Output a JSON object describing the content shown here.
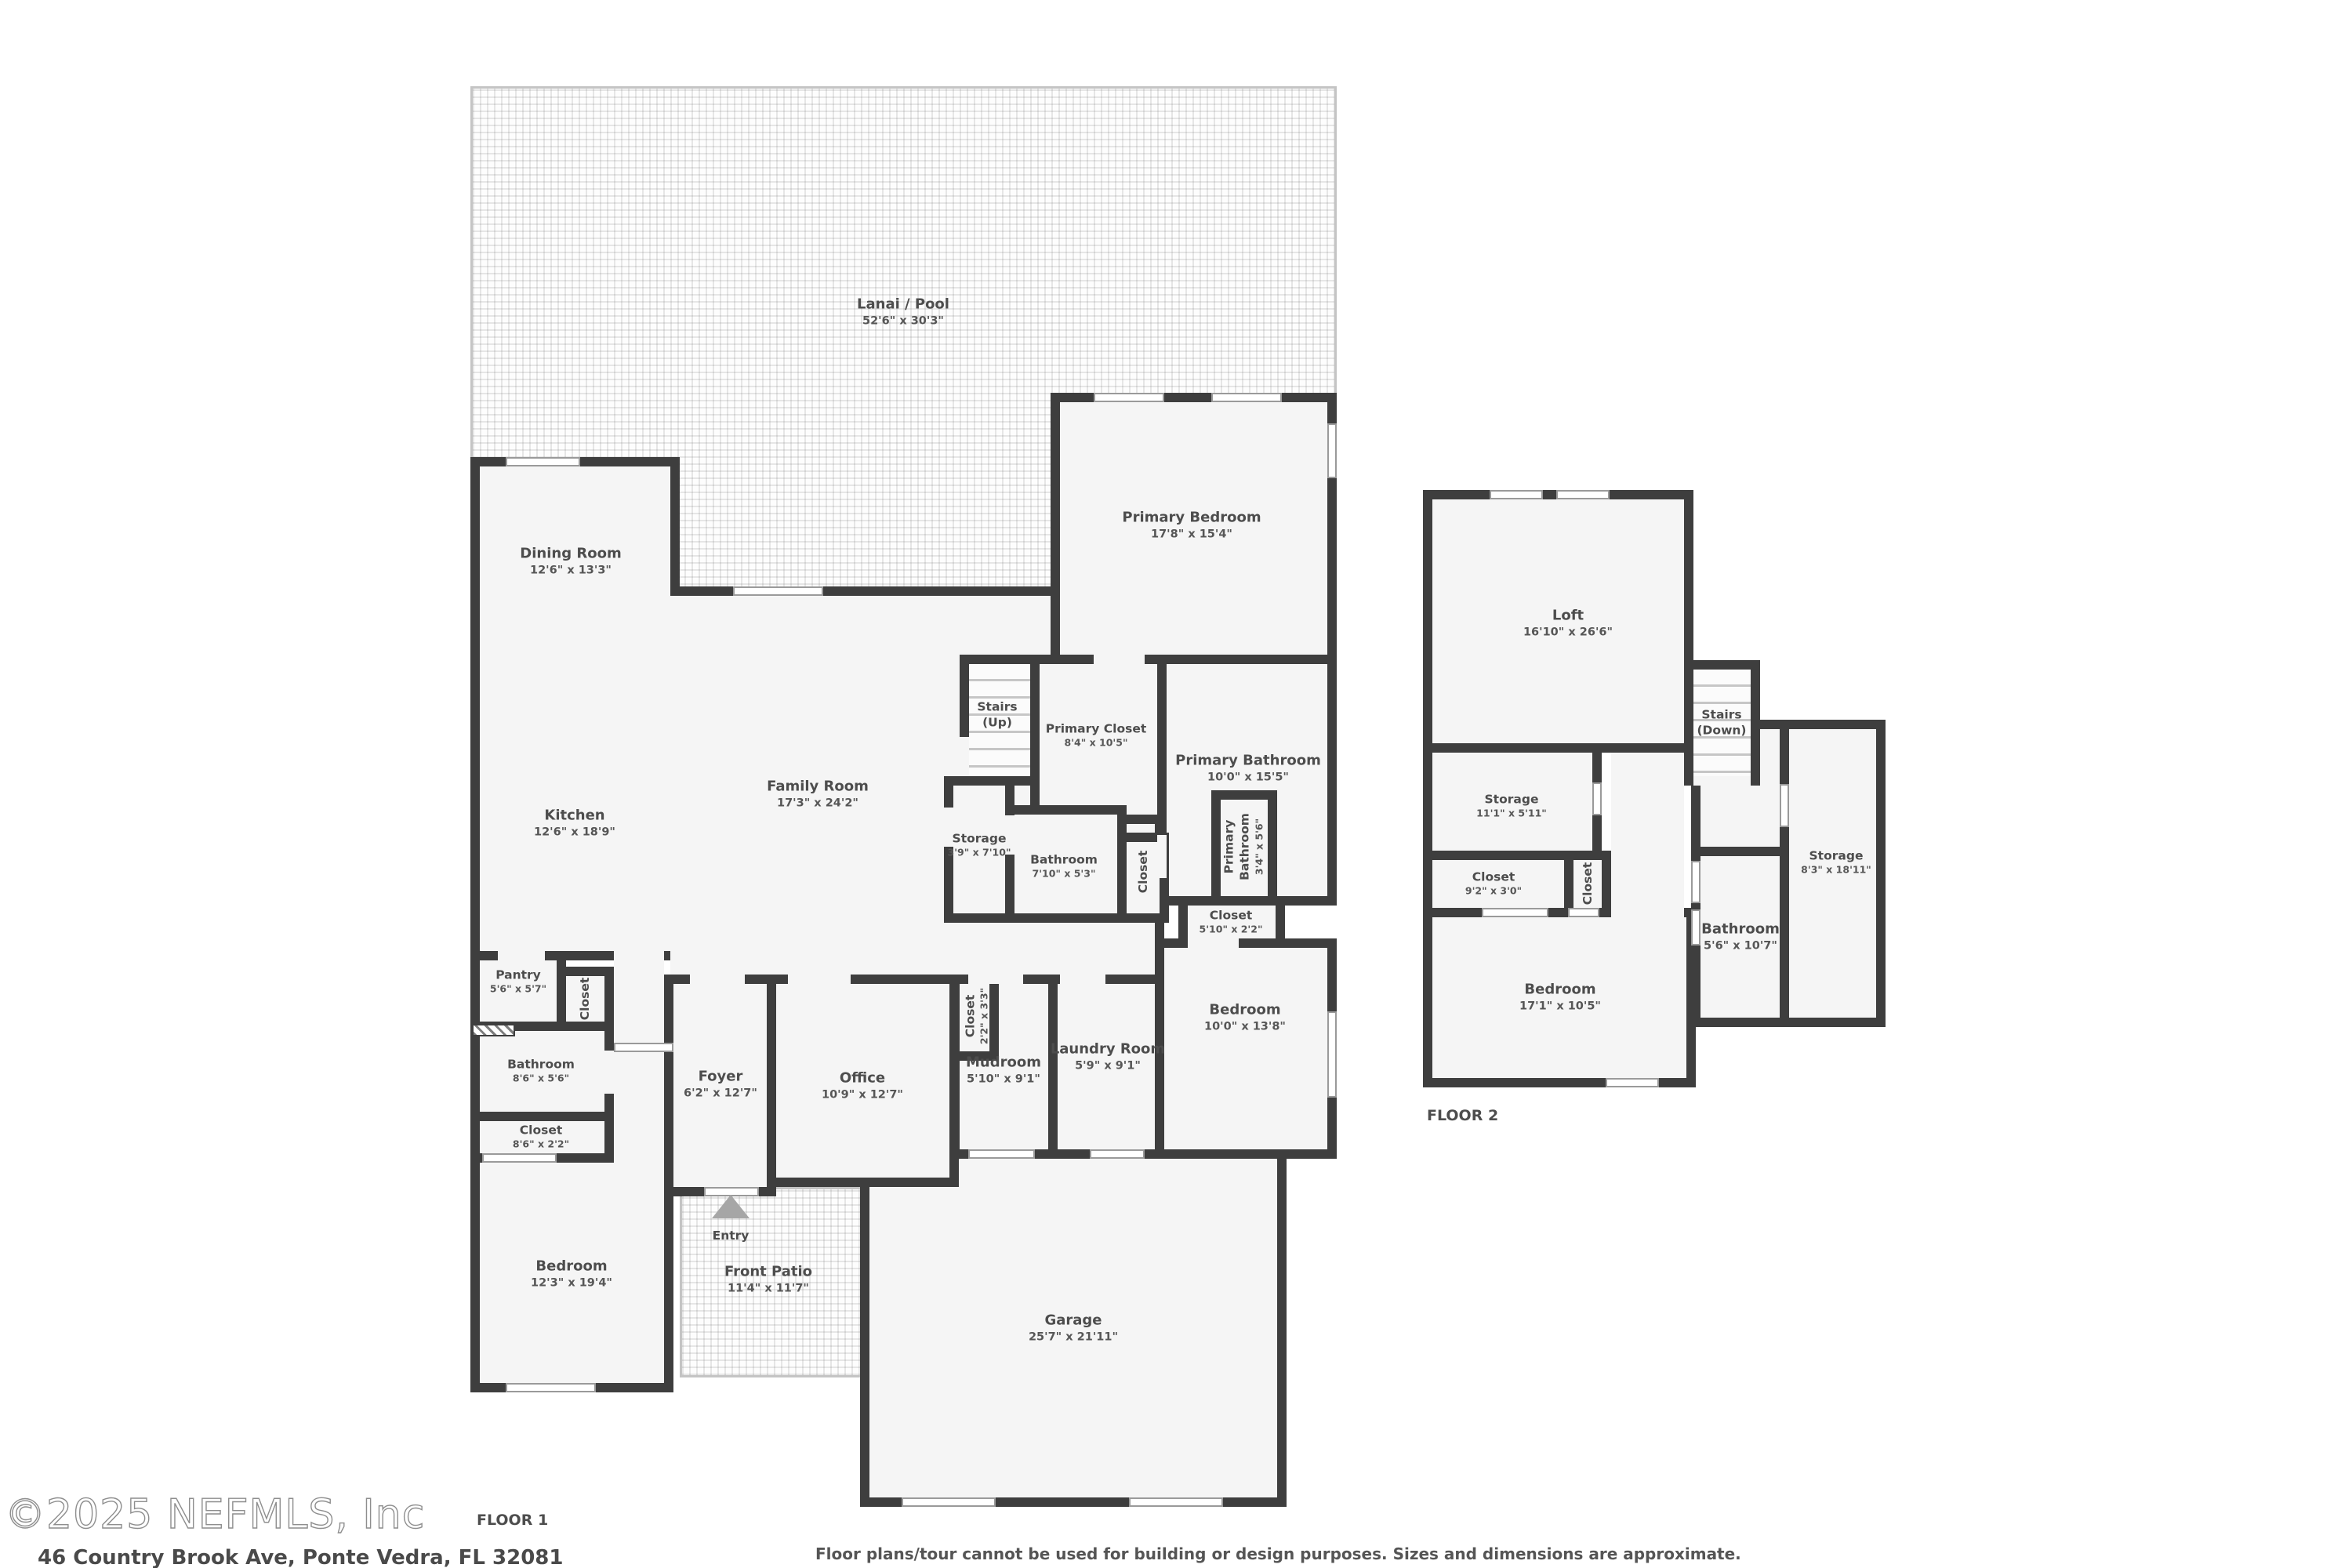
{
  "f1": {
    "floor_label": "FLOOR 1",
    "entry": "Entry",
    "lanai": {
      "name": "Lanai / Pool",
      "dims": "52'6\" x 30'3\""
    },
    "dining": {
      "name": "Dining Room",
      "dims": "12'6\" x 13'3\""
    },
    "kitchen": {
      "name": "Kitchen",
      "dims": "12'6\" x 18'9\""
    },
    "family": {
      "name": "Family Room",
      "dims": "17'3\" x 24'2\""
    },
    "primary_bedroom": {
      "name": "Primary Bedroom",
      "dims": "17'8\" x 15'4\""
    },
    "stairs_up": {
      "name": "Stairs",
      "dims": "(Up)"
    },
    "primary_closet": {
      "name": "Primary Closet",
      "dims": "8'4\" x 10'5\""
    },
    "primary_bathroom": {
      "name": "Primary Bathroom",
      "dims": "10'0\" x 15'5\""
    },
    "storage": {
      "name": "Storage",
      "dims": "3'9\" x 7'10\""
    },
    "hall_bathroom": {
      "name": "Bathroom",
      "dims": "7'10\" x 5'3\""
    },
    "hall_closet": {
      "name": "Closet"
    },
    "primary_wc": {
      "name": "Primary Bathroom",
      "dims": "3'4\" x 5'6\""
    },
    "bedroom2_closet": {
      "name": "Closet",
      "dims": "5'10\" x 2'2\""
    },
    "bedroom2": {
      "name": "Bedroom",
      "dims": "10'0\" x 13'8\""
    },
    "laundry": {
      "name": "Laundry Room",
      "dims": "5'9\" x 9'1\""
    },
    "mudroom": {
      "name": "Mudroom",
      "dims": "5'10\" x 9'1\""
    },
    "mud_closet": {
      "name": "Closet",
      "dims": "2'2\" x 3'3\""
    },
    "office": {
      "name": "Office",
      "dims": "10'9\" x 12'7\""
    },
    "foyer": {
      "name": "Foyer",
      "dims": "6'2\" x 12'7\""
    },
    "pantry": {
      "name": "Pantry",
      "dims": "5'6\" x 5'7\""
    },
    "pantry_closet": {
      "name": "Closet"
    },
    "bathroom2": {
      "name": "Bathroom",
      "dims": "8'6\" x 5'6\""
    },
    "bedroom3_closet": {
      "name": "Closet",
      "dims": "8'6\" x 2'2\""
    },
    "bedroom3": {
      "name": "Bedroom",
      "dims": "12'3\" x 19'4\""
    },
    "front_patio": {
      "name": "Front Patio",
      "dims": "11'4\" x 11'7\""
    },
    "garage": {
      "name": "Garage",
      "dims": "25'7\" x 21'11\""
    }
  },
  "f2": {
    "floor_label": "FLOOR 2",
    "loft": {
      "name": "Loft",
      "dims": "16'10\" x 26'6\""
    },
    "stairs_down": {
      "name": "Stairs",
      "dims": "(Down)"
    },
    "storage1": {
      "name": "Storage",
      "dims": "11'1\" x 5'11\""
    },
    "closet1": {
      "name": "Closet",
      "dims": "9'2\" x 3'0\""
    },
    "closet2": {
      "name": "Closet"
    },
    "storage2": {
      "name": "Storage",
      "dims": "8'3\" x 18'11\""
    },
    "bathroom": {
      "name": "Bathroom",
      "dims": "5'6\" x 10'7\""
    },
    "bedroom": {
      "name": "Bedroom",
      "dims": "17'1\" x 10'5\""
    }
  },
  "footer": {
    "watermark": "©2025 NEFMLS, Inc",
    "address": "46 Country Brook Ave, Ponte Vedra, FL 32081",
    "disclaimer": "Floor plans/tour cannot be used for building or design purposes. Sizes and dimensions are approximate."
  }
}
